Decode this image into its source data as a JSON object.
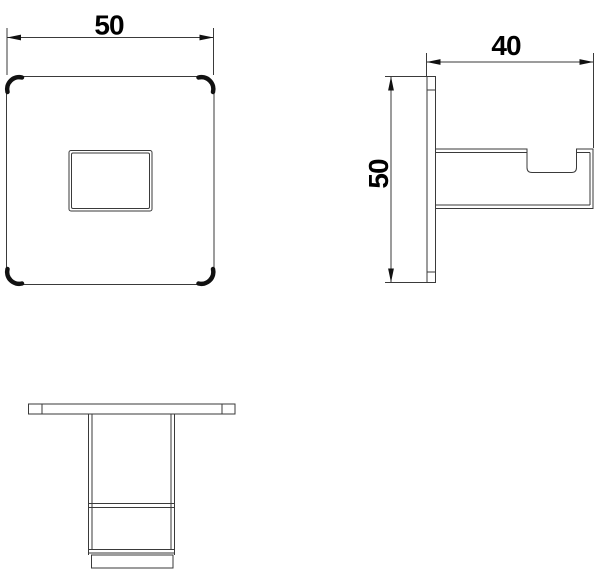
{
  "drawing": {
    "type": "technical-orthographic-drawing",
    "subject": "square-wall-hook",
    "colors": {
      "background": "#ffffff",
      "line": "#222222",
      "dimension_text": "#000000"
    },
    "dimensions": {
      "front_width": "50",
      "side_depth": "40",
      "side_height": "50"
    }
  }
}
